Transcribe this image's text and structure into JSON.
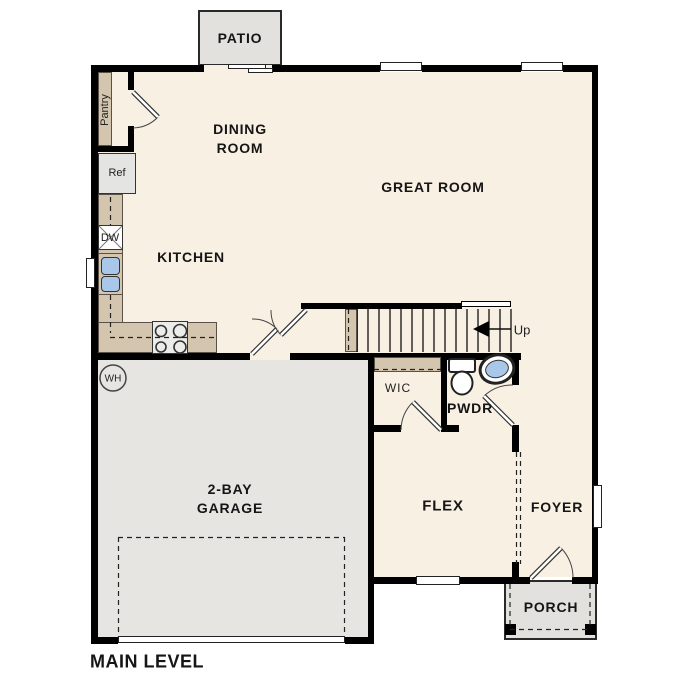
{
  "floor_plan": {
    "title": "MAIN LEVEL",
    "rooms": {
      "patio": "PATIO",
      "dining_line1": "DINING",
      "dining_line2": "ROOM",
      "great_room": "GREAT ROOM",
      "kitchen": "KITCHEN",
      "garage_line1": "2-BAY",
      "garage_line2": "GARAGE",
      "flex": "FLEX",
      "foyer": "FOYER",
      "powder": "PWDR",
      "porch": "PORCH",
      "wic": "WIC"
    },
    "labels": {
      "pantry": "Pantry",
      "refrigerator": "Ref",
      "dishwasher": "DW",
      "water_heater": "WH",
      "stairs_direction": "Up"
    },
    "colors": {
      "floor": "#f8f0e3",
      "garage_floor": "#e6e5e2",
      "outdoor_concrete": "#e2e1de",
      "counter_tan": "#d4c6ae",
      "fixture_blue": "#a9c8e9",
      "wall": "#000000"
    }
  }
}
